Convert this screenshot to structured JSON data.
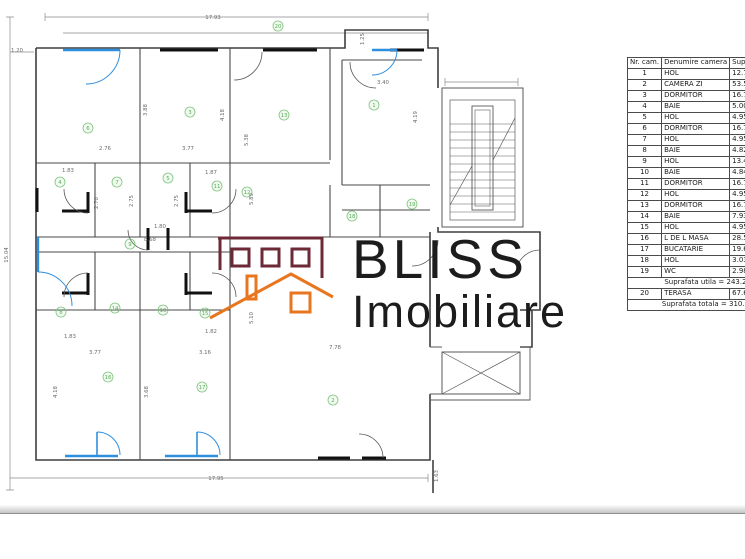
{
  "logo": {
    "title": "BLISS",
    "subtitle": "Imobiliare",
    "brand_maroon": "#6e2937",
    "brand_orange": "#e8761f"
  },
  "table": {
    "headers": {
      "nr": "Nr. cam.",
      "name": "Denumire camera",
      "area": "Suprafata [mp]"
    },
    "rows": [
      {
        "nr": "1",
        "name": "HOL",
        "area": "12.76"
      },
      {
        "nr": "2",
        "name": "CAMERA ZI",
        "area": "53.58"
      },
      {
        "nr": "3",
        "name": "DORMITOR",
        "area": "16.73"
      },
      {
        "nr": "4",
        "name": "BAIE",
        "area": "5.00"
      },
      {
        "nr": "5",
        "name": "HOL",
        "area": "4.95"
      },
      {
        "nr": "6",
        "name": "DORMITOR",
        "area": "16.73"
      },
      {
        "nr": "7",
        "name": "HOL",
        "area": "4.95"
      },
      {
        "nr": "8",
        "name": "BAIE",
        "area": "4.82"
      },
      {
        "nr": "9",
        "name": "HOL",
        "area": "13.46"
      },
      {
        "nr": "10",
        "name": "BAIE",
        "area": "4.84"
      },
      {
        "nr": "11",
        "name": "DORMITOR",
        "area": "16.73"
      },
      {
        "nr": "12",
        "name": "HOL",
        "area": "4.95"
      },
      {
        "nr": "13",
        "name": "DORMITOR",
        "area": "16.73"
      },
      {
        "nr": "14",
        "name": "BAIE",
        "area": "7.93"
      },
      {
        "nr": "15",
        "name": "HOL",
        "area": "4.95"
      },
      {
        "nr": "16",
        "name": "L DE L MASA",
        "area": "28.51"
      },
      {
        "nr": "17",
        "name": "BUCATARIE",
        "area": "19.62"
      },
      {
        "nr": "18",
        "name": "HOL",
        "area": "3.03"
      },
      {
        "nr": "19",
        "name": "WC",
        "area": "2.98"
      }
    ],
    "subtotal_text": "Suprafata utila = 243.25",
    "terrace_row": {
      "nr": "20",
      "name": "TERASA",
      "area": "67.68"
    },
    "total_text": "Suprafata totala = 310.93"
  },
  "plan": {
    "colors": {
      "wall": "#3f3f3f",
      "thin": "#8a8a8a",
      "window_blue": "#2e8fdf",
      "marker_green": "#6cbf6c",
      "dim_gray": "#6b6b6b"
    },
    "room_markers": [
      {
        "n": "20",
        "x": 278,
        "y": 26
      },
      {
        "n": "6",
        "x": 88,
        "y": 128
      },
      {
        "n": "3",
        "x": 190,
        "y": 112
      },
      {
        "n": "13",
        "x": 284,
        "y": 115
      },
      {
        "n": "1",
        "x": 374,
        "y": 105
      },
      {
        "n": "4",
        "x": 60,
        "y": 182
      },
      {
        "n": "7",
        "x": 117,
        "y": 182
      },
      {
        "n": "5",
        "x": 168,
        "y": 178
      },
      {
        "n": "11",
        "x": 217,
        "y": 186
      },
      {
        "n": "12",
        "x": 247,
        "y": 192
      },
      {
        "n": "9",
        "x": 130,
        "y": 244
      },
      {
        "n": "8",
        "x": 61,
        "y": 312
      },
      {
        "n": "14",
        "x": 115,
        "y": 308
      },
      {
        "n": "10",
        "x": 163,
        "y": 310
      },
      {
        "n": "15",
        "x": 205,
        "y": 313
      },
      {
        "n": "18",
        "x": 352,
        "y": 216
      },
      {
        "n": "19",
        "x": 412,
        "y": 204
      },
      {
        "n": "16",
        "x": 108,
        "y": 377
      },
      {
        "n": "17",
        "x": 202,
        "y": 387
      },
      {
        "n": "2",
        "x": 333,
        "y": 400
      }
    ],
    "dimensions": [
      {
        "t": "17.93",
        "x": 213,
        "y": 19,
        "rot": 0
      },
      {
        "t": "1.20",
        "x": 17,
        "y": 52,
        "rot": 0
      },
      {
        "t": "15.04",
        "x": 8,
        "y": 255,
        "rot": -90
      },
      {
        "t": "17.95",
        "x": 216,
        "y": 480,
        "rot": 0
      },
      {
        "t": "1.25",
        "x": 364,
        "y": 39,
        "rot": -90
      },
      {
        "t": "2.76",
        "x": 105,
        "y": 150,
        "rot": 0
      },
      {
        "t": "3.77",
        "x": 188,
        "y": 150,
        "rot": 0
      },
      {
        "t": "3.88",
        "x": 147,
        "y": 110,
        "rot": -90
      },
      {
        "t": "4.18",
        "x": 224,
        "y": 115,
        "rot": -90
      },
      {
        "t": "5.38",
        "x": 248,
        "y": 140,
        "rot": -90
      },
      {
        "t": "3.40",
        "x": 383,
        "y": 84,
        "rot": 0
      },
      {
        "t": "4.19",
        "x": 417,
        "y": 117,
        "rot": -90
      },
      {
        "t": "1.83",
        "x": 68,
        "y": 172,
        "rot": 0
      },
      {
        "t": "1.87",
        "x": 211,
        "y": 174,
        "rot": 0
      },
      {
        "t": "2.70",
        "x": 98,
        "y": 203,
        "rot": -90
      },
      {
        "t": "2.75",
        "x": 133,
        "y": 201,
        "rot": -90
      },
      {
        "t": "2.75",
        "x": 178,
        "y": 201,
        "rot": -90
      },
      {
        "t": "5.89",
        "x": 253,
        "y": 199,
        "rot": -90
      },
      {
        "t": "1.80",
        "x": 160,
        "y": 228,
        "rot": 0
      },
      {
        "t": "8.68",
        "x": 150,
        "y": 241,
        "rot": 0
      },
      {
        "t": "1.83",
        "x": 70,
        "y": 338,
        "rot": 0
      },
      {
        "t": "1.82",
        "x": 211,
        "y": 333,
        "rot": 0
      },
      {
        "t": "3.77",
        "x": 95,
        "y": 354,
        "rot": 0
      },
      {
        "t": "3.16",
        "x": 205,
        "y": 354,
        "rot": 0
      },
      {
        "t": "4.18",
        "x": 57,
        "y": 392,
        "rot": -90
      },
      {
        "t": "3.68",
        "x": 148,
        "y": 392,
        "rot": -90
      },
      {
        "t": "5.10",
        "x": 253,
        "y": 318,
        "rot": -90
      },
      {
        "t": "7.78",
        "x": 335,
        "y": 349,
        "rot": 0
      },
      {
        "t": "1.63",
        "x": 438,
        "y": 476,
        "rot": -90
      }
    ]
  }
}
